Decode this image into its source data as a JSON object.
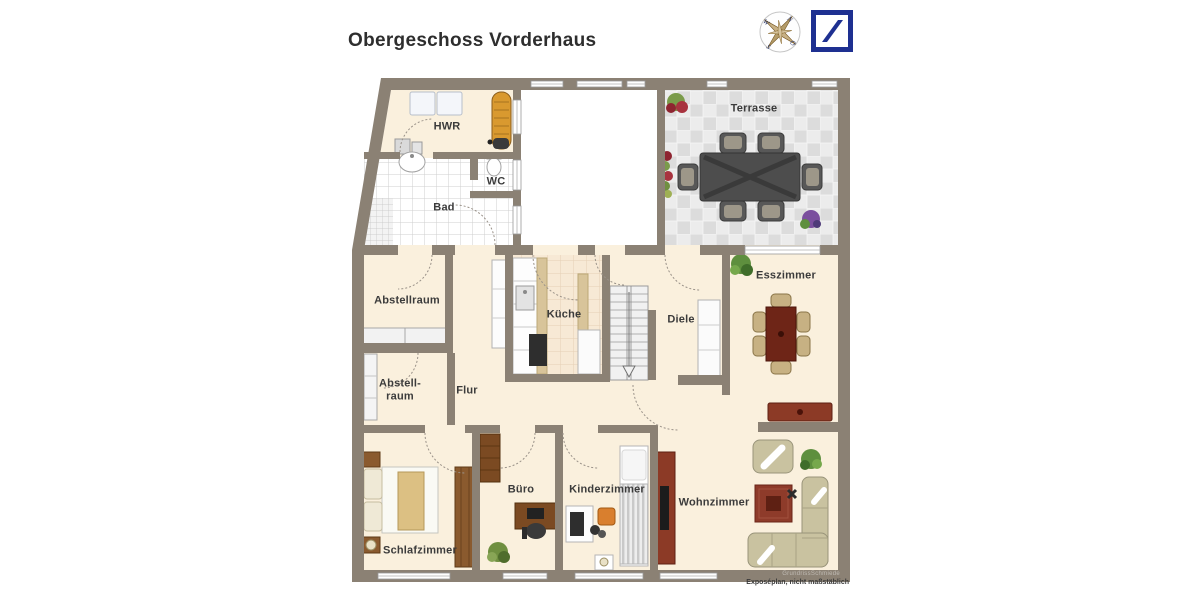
{
  "header": {
    "title": "Obergeschoss Vorderhaus"
  },
  "compass": {
    "n": "N",
    "e": "O",
    "s": "S",
    "w": "W"
  },
  "floorplan": {
    "rooms": [
      {
        "id": "hwr",
        "label": "HWR"
      },
      {
        "id": "wc",
        "label": "WC"
      },
      {
        "id": "bad",
        "label": "Bad"
      },
      {
        "id": "terrasse",
        "label": "Terrasse"
      },
      {
        "id": "abstellraum",
        "label": "Abstellraum"
      },
      {
        "id": "kueche",
        "label": "Küche"
      },
      {
        "id": "diele",
        "label": "Diele"
      },
      {
        "id": "esszimmer",
        "label": "Esszimmer"
      },
      {
        "id": "abstellraum-2",
        "label": "Abstell-\nraum"
      },
      {
        "id": "flur",
        "label": "Flur"
      },
      {
        "id": "schlafzimmer",
        "label": "Schlafzimmer"
      },
      {
        "id": "buero",
        "label": "Büro"
      },
      {
        "id": "kinderzimmer",
        "label": "Kinderzimmer"
      },
      {
        "id": "wohnzimmer",
        "label": "Wohnzimmer"
      }
    ],
    "footnote": "Exposéplan, nicht maßstäblich",
    "watermark": "GrundrissSchmiede"
  },
  "colors": {
    "wall": "#8b8174",
    "floor": "#faf0dd",
    "logo_blue": "#1e3091"
  }
}
